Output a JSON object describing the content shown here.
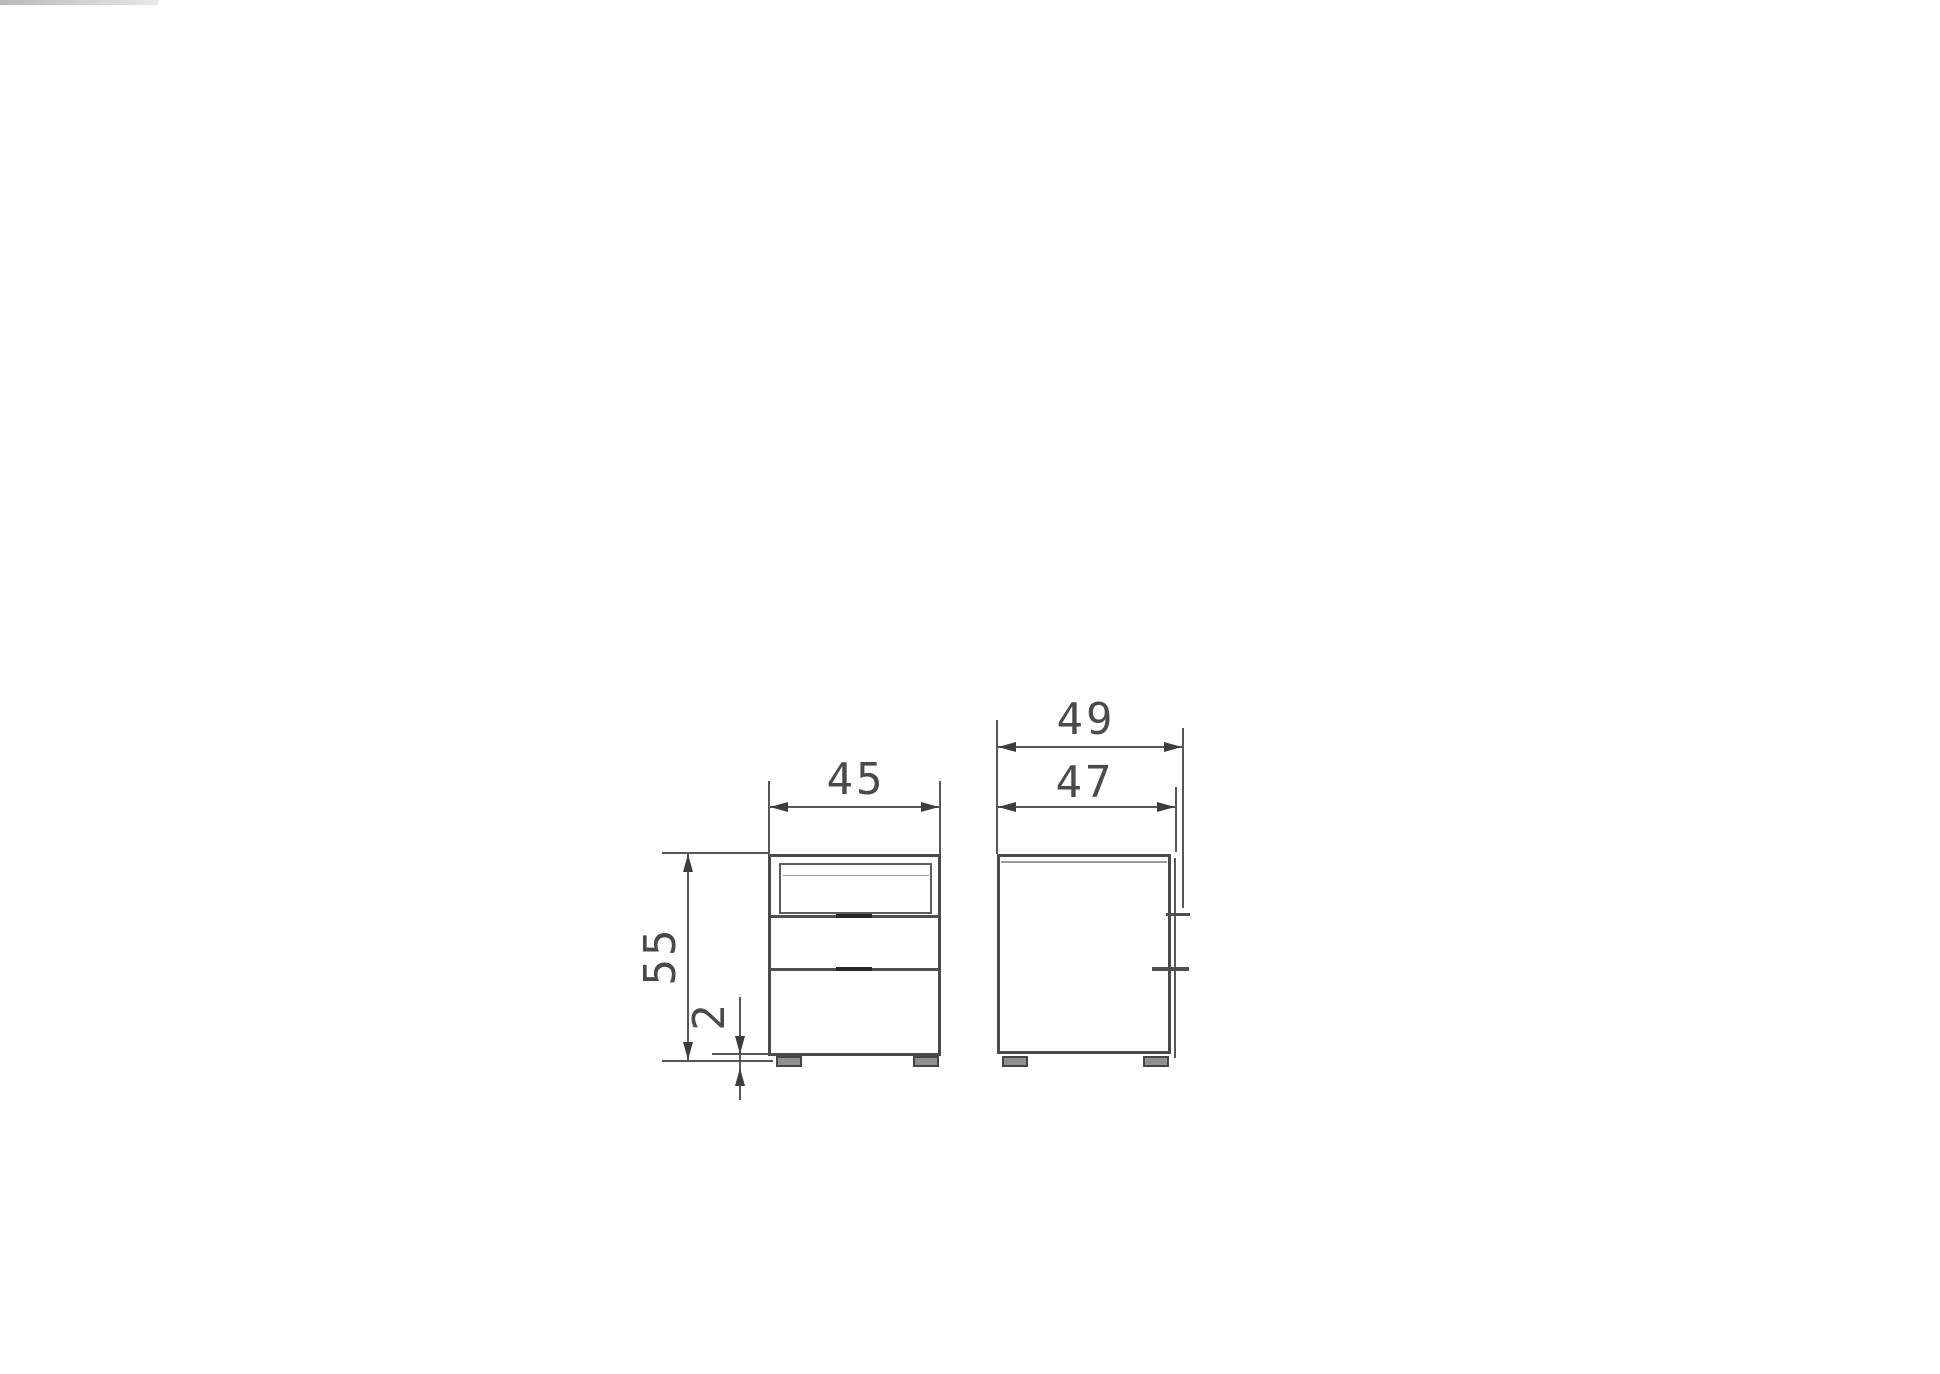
{
  "drawing": {
    "front_view": {
      "width": "45",
      "height": "55",
      "foot_height": "2"
    },
    "side_view": {
      "depth_overall": "49",
      "depth_body": "47"
    }
  },
  "colors": {
    "background": "#ffffff",
    "object_line": "#4a4a4a",
    "dimension_line": "#575757",
    "label_text": "#4a4a4a",
    "foot_fill": "#8f8f8f"
  }
}
